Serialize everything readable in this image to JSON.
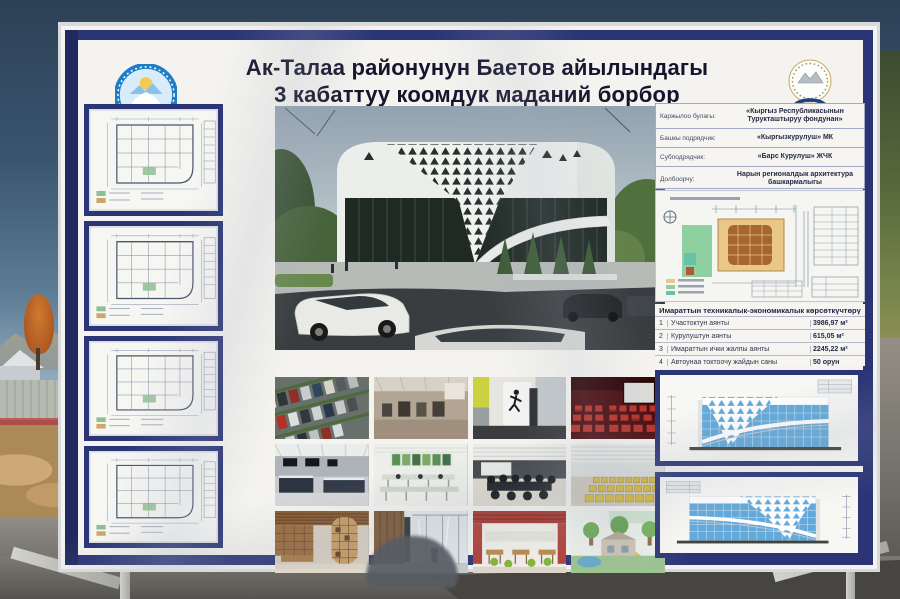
{
  "poster": {
    "title_line1": "Ак-Талаа районунун Баетов айылындагы",
    "title_line2": "3 кабаттуу коомдук маданий борбор",
    "project_info": {
      "rows": [
        {
          "label": "Каржылоо булагы:",
          "value": "«Кыргыз Республикасынын Турукташтыруу фондунан»"
        },
        {
          "label": "Башкы подрядчик:",
          "value": "«Кыргызкурулуш» МК"
        },
        {
          "label": "Субподрядчик:",
          "value": "«Барс Курулуш» ЖЧК"
        },
        {
          "label": "Долбоорчу:",
          "value": "Нарын регионалдык архитектура башкармалыгы"
        }
      ]
    },
    "indicators": {
      "header": "Имараттын техникалык-экономикалык көрсөткүчтөрү",
      "rows": [
        {
          "num": "1",
          "label": "Участоктун аянты",
          "value": "3986,97 м²"
        },
        {
          "num": "2",
          "label": "Курулуштун аянты",
          "value": "615,05 м²"
        },
        {
          "num": "3",
          "label": "Имараттын ички жалпы аянты",
          "value": "2245,22 м²"
        },
        {
          "num": "4",
          "label": "Автоунаа токтоочу жайдын саны",
          "value": "50 орун"
        }
      ]
    },
    "colors": {
      "frame_navy": "#2b3575",
      "banner_white": "#f4f3ef",
      "elevation_blue": "#63a9da",
      "cinema_red": "#b93227",
      "emblem_blue": "#1d7ec6",
      "logo_navy": "#21407f"
    }
  }
}
